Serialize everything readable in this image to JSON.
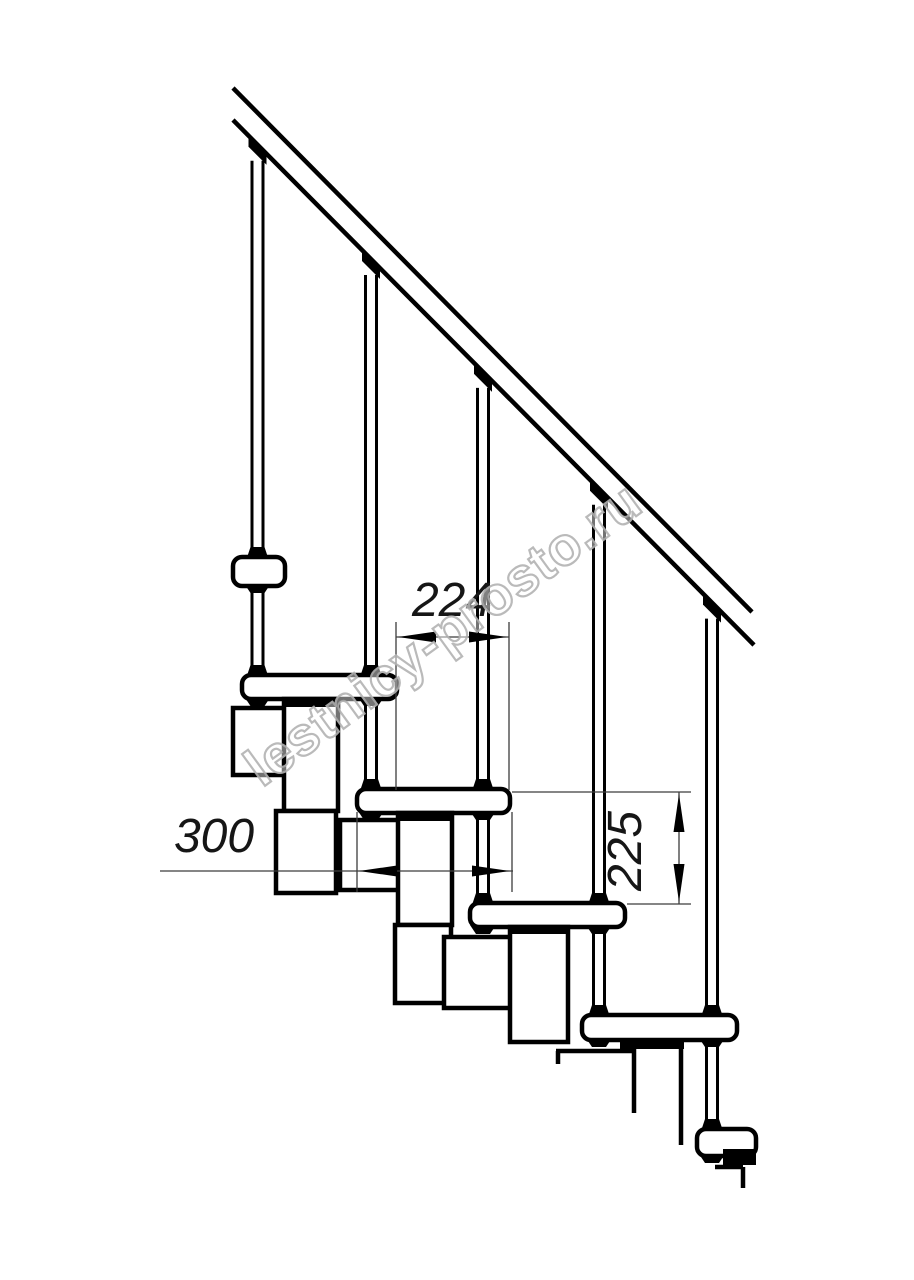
{
  "page": {
    "background": "#ffffff"
  },
  "watermark": {
    "text": "lestnicy-prosto.ru",
    "x": 262,
    "y": 788,
    "angle": -36,
    "font_size": 54,
    "stroke": "#b3b3b3",
    "fill": "rgba(255,255,255,0.5)"
  },
  "dimensions": {
    "step_run": {
      "label": "224"
    },
    "tread_depth": {
      "label": "300"
    },
    "step_rise": {
      "label": "225"
    }
  },
  "colors": {
    "line": "#000000",
    "thin_line": "#3c3c3c",
    "dim_text": "#161616",
    "fill": "#ffffff"
  },
  "drawing": {
    "stroke_thick": 4.5,
    "stroke_baluster": 3,
    "stroke_thin": 1.3,
    "rail": {
      "upper": [
        233,
        88,
        752,
        612
      ],
      "lower": [
        233,
        120,
        754,
        645
      ]
    },
    "balusters": [
      {
        "cx": 257.5,
        "bottom": 675
      },
      {
        "cx": 371,
        "bottom": 789
      },
      {
        "cx": 483,
        "bottom": 903
      },
      {
        "cx": 599,
        "bottom": 1016
      },
      {
        "cx": 712,
        "bottom": 1130
      }
    ],
    "treads": [
      {
        "x": 233,
        "y": 557,
        "w": 52,
        "h": 29
      },
      {
        "x": 242,
        "y": 675,
        "w": 155,
        "h": 24
      },
      {
        "x": 357,
        "y": 789,
        "w": 153,
        "h": 24
      },
      {
        "x": 470,
        "y": 903,
        "w": 155,
        "h": 24
      },
      {
        "x": 582,
        "y": 1015,
        "w": 155,
        "h": 25
      },
      {
        "x": 697,
        "y": 1129,
        "w": 59,
        "h": 27
      }
    ],
    "boxes": [
      {
        "x": 233,
        "y": 708,
        "w": 57,
        "h": 67
      },
      {
        "x": 284,
        "y": 699,
        "w": 54,
        "h": 112
      },
      {
        "x": 276,
        "y": 811,
        "w": 60,
        "h": 82
      },
      {
        "x": 340,
        "y": 820,
        "w": 64,
        "h": 70
      },
      {
        "x": 398,
        "y": 813,
        "w": 54,
        "h": 112
      },
      {
        "x": 395,
        "y": 925,
        "w": 56,
        "h": 78
      },
      {
        "x": 444,
        "y": 937,
        "w": 70,
        "h": 71
      },
      {
        "x": 510,
        "y": 927,
        "w": 58,
        "h": 115
      }
    ],
    "black_bars": [
      {
        "x": 284,
        "y": 698,
        "w": 56,
        "h": 9
      },
      {
        "x": 398,
        "y": 812,
        "w": 56,
        "h": 9
      },
      {
        "x": 510,
        "y": 926,
        "w": 58,
        "h": 8
      },
      {
        "x": 620,
        "y": 1040,
        "w": 64,
        "h": 9
      },
      {
        "x": 723,
        "y": 1149,
        "w": 33,
        "h": 16
      }
    ],
    "collars": [
      {
        "cx": 257.5,
        "y": 558
      },
      {
        "cx": 257.5,
        "y": 676
      },
      {
        "cx": 371,
        "y": 676
      },
      {
        "cx": 371,
        "y": 790
      },
      {
        "cx": 483,
        "y": 790
      },
      {
        "cx": 483,
        "y": 904
      },
      {
        "cx": 599,
        "y": 904
      },
      {
        "cx": 599,
        "y": 1016
      },
      {
        "cx": 712,
        "y": 1016
      },
      {
        "cx": 712,
        "y": 1130
      }
    ],
    "underclamps": [
      {
        "cx": 257.5,
        "y": 585
      },
      {
        "cx": 257.5,
        "y": 698
      },
      {
        "cx": 371,
        "y": 698
      },
      {
        "cx": 371,
        "y": 812
      },
      {
        "cx": 483,
        "y": 812
      },
      {
        "cx": 483,
        "y": 926
      },
      {
        "cx": 599,
        "y": 926
      },
      {
        "cx": 599,
        "y": 1039
      },
      {
        "cx": 712,
        "y": 1039
      },
      {
        "cx": 712,
        "y": 1155
      }
    ],
    "fragment_lines": [
      [
        556,
        1051,
        633,
        1051
      ],
      [
        558,
        1051,
        558,
        1064
      ],
      [
        634,
        1048,
        634,
        1113
      ],
      [
        681,
        1048,
        681,
        1145
      ],
      [
        715,
        1167,
        743,
        1167
      ],
      [
        743,
        1167,
        743,
        1188
      ]
    ],
    "thin_lines": [
      [
        396,
        622,
        396,
        790
      ],
      [
        509,
        622,
        509,
        790
      ],
      [
        396,
        637,
        509,
        637
      ],
      [
        357,
        812,
        357,
        892
      ],
      [
        512,
        812,
        512,
        892
      ],
      [
        160,
        871,
        513,
        871
      ],
      [
        512,
        792,
        691,
        792
      ],
      [
        627,
        904,
        691,
        904
      ],
      [
        679,
        792,
        679,
        904
      ]
    ],
    "arrows": [
      {
        "tip": [
          398,
          637
        ],
        "dir": "left"
      },
      {
        "tip": [
          507,
          637
        ],
        "dir": "right"
      },
      {
        "tip": [
          359,
          871
        ],
        "dir": "left"
      },
      {
        "tip": [
          510,
          871
        ],
        "dir": "right"
      },
      {
        "tip": [
          679,
          794
        ],
        "dir": "up"
      },
      {
        "tip": [
          679,
          902
        ],
        "dir": "down"
      }
    ],
    "dim_texts": [
      {
        "ref": "step_run",
        "x": 452,
        "y": 616,
        "rotate": 0,
        "size": 48
      },
      {
        "ref": "tread_depth",
        "x": 214,
        "y": 852,
        "rotate": 0,
        "size": 48
      },
      {
        "ref": "step_rise",
        "x": 641,
        "y": 851,
        "rotate": -90,
        "size": 48
      }
    ]
  }
}
